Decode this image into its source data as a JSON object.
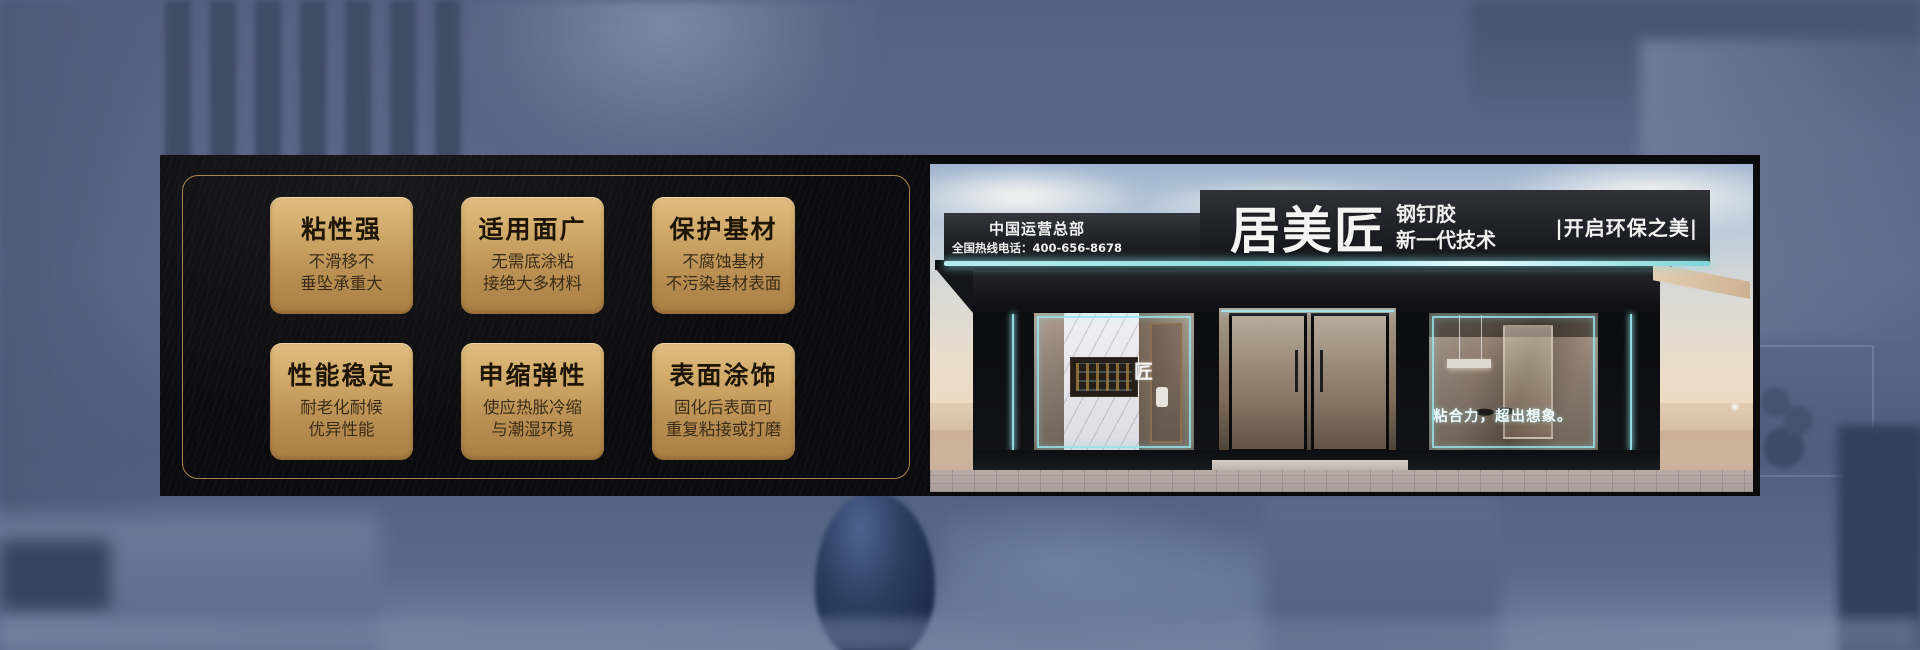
{
  "features": [
    {
      "title": "粘性强",
      "line1": "不滑移不",
      "line2": "垂坠承重大"
    },
    {
      "title": "适用面广",
      "line1": "无需底涂粘",
      "line2": "接绝大多材料"
    },
    {
      "title": "保护基材",
      "line1": "不腐蚀基材",
      "line2": "不污染基材表面"
    },
    {
      "title": "性能稳定",
      "line1": "耐老化耐候",
      "line2": "优异性能"
    },
    {
      "title": "申缩弹性",
      "line1": "使应热胀冷缩",
      "line2": "与潮湿环境"
    },
    {
      "title": "表面涂饰",
      "line1": "固化后表面可",
      "line2": "重复粘接或打磨"
    }
  ],
  "storefront": {
    "hq_label": "中国运营总部",
    "hotline": "全国热线电话：400-656-8678",
    "brand": "居美匠",
    "product": "钢钉胶",
    "tech_line": "新一代技术",
    "eco_slogan": "|开启环保之美|",
    "window_slogan": "粘合力，超出想象。",
    "glass_logo": "匠"
  },
  "colors": {
    "gold_card_top": "#e0bd82",
    "gold_card_bottom": "#aa7e43",
    "gold_border": "#a9854e",
    "panel_black": "#0b0b0d",
    "neon_cyan": "#8fdbe2",
    "card_title_text": "#1e1506",
    "card_sub_text": "#3a2d18",
    "sign_text": "#f2f2f2",
    "background_blue": "#5d6c8a"
  }
}
